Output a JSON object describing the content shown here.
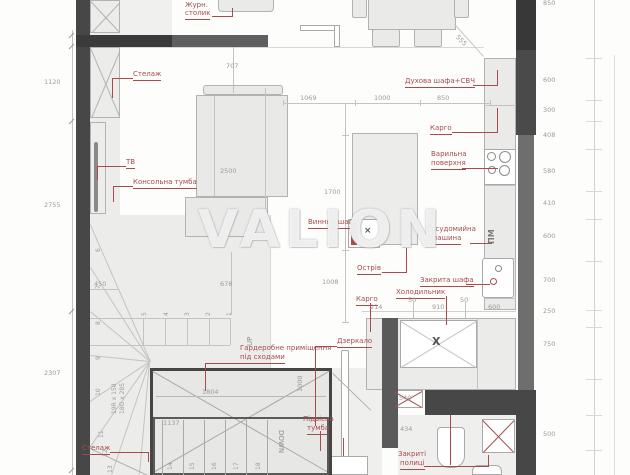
{
  "watermark": "VALION",
  "accent_color": "#a84b4d",
  "labels": {
    "coffee_table": [
      "Журн.",
      "столик"
    ],
    "shelf_top": "Стелаж",
    "tv": "ТВ",
    "console": "Консольна тумба",
    "oven": "Духова шафа+СВЧ",
    "cargo_upper": "Карго",
    "hob": [
      "Варильна",
      "поверхня"
    ],
    "wine": "Винний шаф",
    "dishwasher": [
      "Посудомийна",
      "машина"
    ],
    "island": "Острів",
    "closed_cabinet": "Закрита шафа",
    "fridge": "Холодильник",
    "cargo_lower": "Карго",
    "mirror": "Дзеркало",
    "wardrobe": [
      "Гардеробне приміщення",
      "під сходами"
    ],
    "hanging": [
      "Підвісна",
      "тумба"
    ],
    "shelf_bottom": "Стелаж",
    "closed_shelves": [
      "Закриті",
      "полиці"
    ]
  },
  "stairs": {
    "up": "UP",
    "down": "DOWN",
    "spec": [
      "19R x 158",
      "18G x 285"
    ],
    "upper_steps": [
      "1",
      "2",
      "3",
      "4",
      "5"
    ],
    "winders": [
      "6",
      "7",
      "8",
      "9",
      "10",
      "11",
      "12",
      "13"
    ],
    "lower_steps": [
      "14",
      "15",
      "16",
      "17",
      "18"
    ]
  },
  "markers": {
    "storage_x": "X",
    "dishwasher_mark": "ПМ"
  },
  "dims": {
    "left": [
      "1120",
      "2755",
      "2307"
    ],
    "right": [
      "850",
      "600",
      "300",
      "408",
      "580",
      "410",
      "600",
      "700",
      "250",
      "750",
      "500"
    ],
    "top": {
      "sofa_gap": "707",
      "diag": "555",
      "living": [
        "1069",
        "1000",
        "850"
      ]
    },
    "inner": {
      "sofa": "2500",
      "island": "1700",
      "island_gap": "1008",
      "niche": "450",
      "stair_gap": "678",
      "closet_w": "1804",
      "closet_inner": "1137",
      "mirror_gap": "1000",
      "counter": [
        "214",
        "50",
        "910",
        "50",
        "600"
      ],
      "box540": "540",
      "box434": "434"
    }
  }
}
